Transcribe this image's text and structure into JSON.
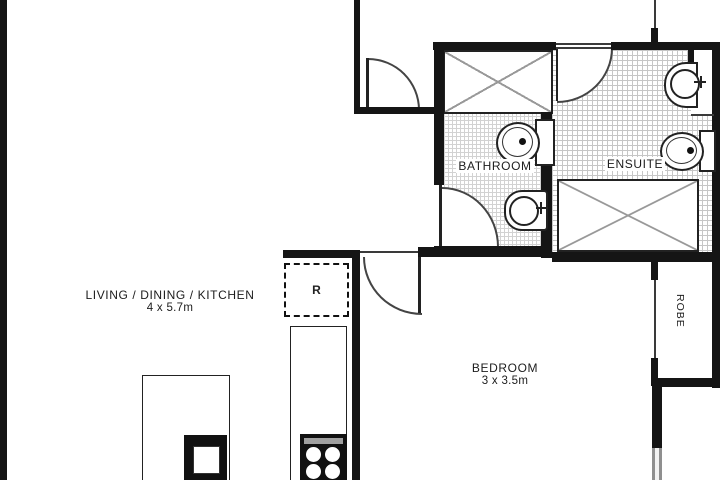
{
  "floorplan": {
    "rooms": {
      "living": {
        "name": "LIVING / DINING / KITCHEN",
        "dimensions": "4 x 5.7m"
      },
      "bedroom": {
        "name": "BEDROOM",
        "dimensions": "3 x 3.5m"
      },
      "bathroom": {
        "name": "BATHROOM"
      },
      "ensuite": {
        "name": "ENSUITE"
      },
      "robe": {
        "name": "ROBE"
      }
    },
    "appliances": {
      "refrigerator_symbol": "R"
    },
    "colors": {
      "wall": "#151515",
      "background": "#ffffff",
      "tile_line": "#c6c6c6",
      "cross_line": "#999999",
      "fixture_line": "#222222"
    }
  }
}
